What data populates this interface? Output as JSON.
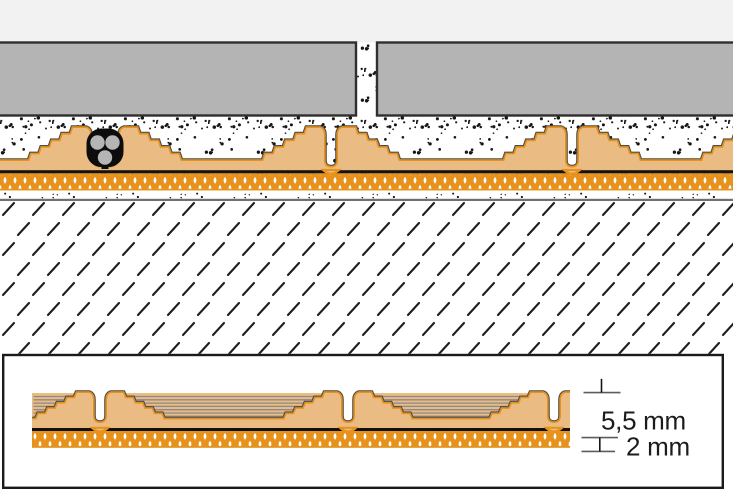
{
  "diagram": {
    "type": "floor-assembly-cross-section",
    "dimensions": {
      "total_height_label": "5,5 mm",
      "fleece_thickness_label": "2 mm"
    },
    "colors": {
      "page_background": "#ffffff",
      "top_band": "#f2f2f2",
      "tile_fill": "#b4b4b4",
      "tile_border": "#2f2f2f",
      "stipple_dot": "#161616",
      "membrane_tan": "#eabc83",
      "membrane_orange": "#e6921c",
      "outline_dark": "#4d4d4d",
      "line_black": "#121212",
      "substrate_line": "#6f6f6f",
      "hatch_dash": "#1f1f1f",
      "cable_black": "#0c0c0c",
      "conductor_gray": "#b5b5b5",
      "terrace_gray": "#8a8a8a",
      "dimension_line_gray": "#5d5d5d",
      "dimension_tick_black": "#161616",
      "label_text": "#1c1c1c",
      "inset_background": "#ffffff",
      "inset_border": "#1a1a1a"
    }
  }
}
